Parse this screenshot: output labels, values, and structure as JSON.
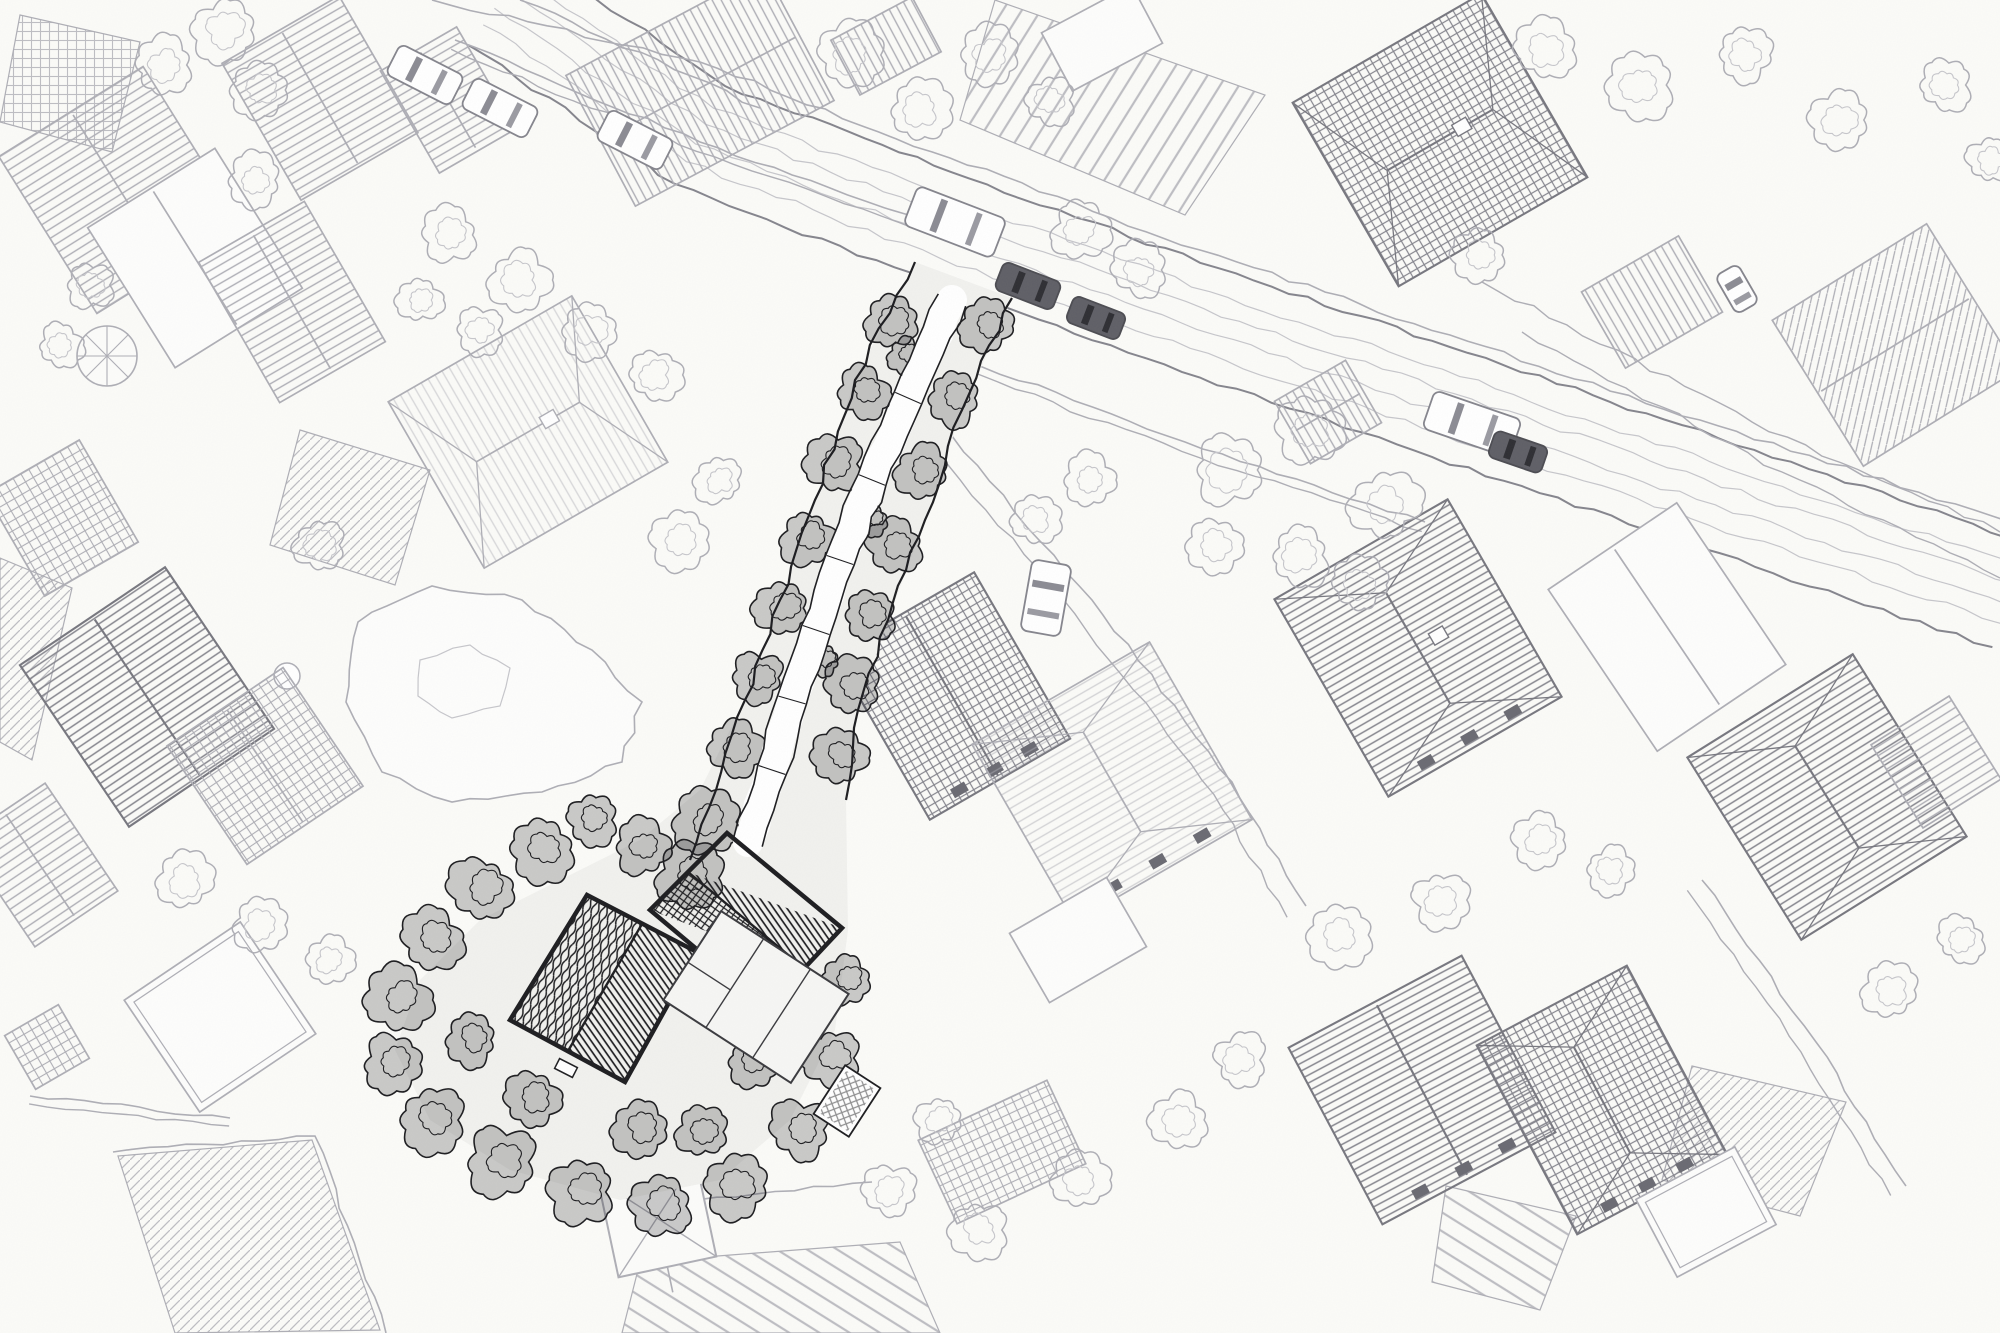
{
  "meta": {
    "title": "Hand-drawn aerial pen sketch of a residential neighborhood with one dark highlighted plot",
    "style": "pen-and-ink aerial view, no text, no UI chrome"
  },
  "canvas": {
    "w": 2000,
    "h": 1333
  },
  "palette": {
    "paper": "#fbfbf8",
    "paper_shade": "#f1f1ee",
    "ink_faint": "#c6c6cb",
    "ink_light": "#aeaeb5",
    "ink_mid": "#85858d",
    "ink_dark": "#1d1d20",
    "veg_dark_fill": "rgba(25,25,28,0.22)",
    "car_dark": "#5f5f66",
    "window_dark": "#6a6a72"
  },
  "road": {
    "center": [
      [
        500,
        0
      ],
      [
        700,
        135
      ],
      [
        950,
        230
      ],
      [
        1200,
        320
      ],
      [
        1450,
        405
      ],
      [
        1700,
        490
      ],
      [
        2010,
        595
      ]
    ],
    "half_width": 55,
    "inner_offsets": [
      -30,
      -12,
      10,
      30
    ],
    "sidewalk_north": [
      [
        432,
        0
      ],
      [
        700,
        62
      ],
      [
        950,
        158
      ],
      [
        1200,
        250
      ],
      [
        1450,
        335
      ],
      [
        1700,
        420
      ],
      [
        2010,
        522
      ]
    ],
    "verge_curves": [
      [
        [
          1482,
          282
        ],
        [
          1752,
          422
        ],
        [
          2000,
          532
        ]
      ],
      [
        [
          1522,
          332
        ],
        [
          1782,
          472
        ],
        [
          2000,
          578
        ]
      ]
    ]
  },
  "houses": [
    {
      "cx": 120,
      "cy": 190,
      "w": 170,
      "h": 185,
      "rot": -32,
      "fill": "stripe",
      "tone": "light",
      "roof": "gable"
    },
    {
      "cx": 195,
      "cy": 258,
      "w": 150,
      "h": 165,
      "rot": -32,
      "fill": "plain",
      "tone": "light",
      "roof": "gable"
    },
    {
      "cx": 320,
      "cy": 98,
      "w": 135,
      "h": 158,
      "rot": -30,
      "fill": "stripe",
      "tone": "light",
      "roof": "gable"
    },
    {
      "cx": 448,
      "cy": 100,
      "w": 88,
      "h": 118,
      "rot": -30,
      "fill": "stripe",
      "tone": "light",
      "roof": "gable"
    },
    {
      "cx": 700,
      "cy": 88,
      "w": 225,
      "h": 148,
      "rot": -28,
      "fill": "stripe",
      "tone": "light",
      "roof": "gable"
    },
    {
      "cx": 292,
      "cy": 302,
      "w": 122,
      "h": 162,
      "rot": -30,
      "fill": "stripe",
      "tone": "light",
      "roof": "gable"
    },
    {
      "cx": 528,
      "cy": 432,
      "w": 212,
      "h": 192,
      "rot": -30,
      "fill": "stripe",
      "fo": 0.45,
      "tone": "light",
      "roof": "hip",
      "chimney": true
    },
    {
      "cx": 952,
      "cy": 696,
      "w": 162,
      "h": 192,
      "rot": -30,
      "fill": "grid",
      "tone": "mid",
      "roof": "gable",
      "windows": true
    },
    {
      "cx": 1112,
      "cy": 782,
      "w": 205,
      "h": 205,
      "rot": -30,
      "fill": "stripe",
      "fo": 0.5,
      "tone": "light",
      "roof": "hip",
      "windows": true
    },
    {
      "cx": 1440,
      "cy": 140,
      "w": 218,
      "h": 212,
      "rot": -30,
      "fill": "grid",
      "tone": "mid",
      "roof": "hip",
      "chimney": true
    },
    {
      "cx": 1652,
      "cy": 302,
      "w": 112,
      "h": 88,
      "rot": -30,
      "fill": "stripe",
      "tone": "light",
      "roof": "flat"
    },
    {
      "cx": 1895,
      "cy": 345,
      "w": 182,
      "h": 172,
      "rot": -32,
      "fill": "hatch",
      "tone": "light",
      "roof": "gable"
    },
    {
      "cx": 1418,
      "cy": 648,
      "w": 200,
      "h": 228,
      "rot": -30,
      "fill": "stripe",
      "tone": "mid",
      "roof": "hip",
      "windows": true,
      "chimney": true
    },
    {
      "cx": 1667,
      "cy": 627,
      "w": 155,
      "h": 195,
      "rot": -34,
      "fill": "plain",
      "tone": "light",
      "roof": "gable"
    },
    {
      "cx": 1827,
      "cy": 797,
      "w": 195,
      "h": 215,
      "rot": -32,
      "fill": "stripe",
      "tone": "mid",
      "roof": "hip"
    },
    {
      "cx": 1422,
      "cy": 1090,
      "w": 196,
      "h": 200,
      "rot": -28,
      "fill": "stripe",
      "tone": "mid",
      "roof": "gable",
      "windows": true
    },
    {
      "cx": 1602,
      "cy": 1100,
      "w": 170,
      "h": 214,
      "rot": -28,
      "fill": "grid",
      "tone": "mid",
      "roof": "hip",
      "windows": true
    },
    {
      "cx": 147,
      "cy": 697,
      "w": 175,
      "h": 195,
      "rot": -34,
      "fill": "stripe",
      "tone": "mid",
      "roof": "gable"
    },
    {
      "cx": 265,
      "cy": 766,
      "w": 140,
      "h": 143,
      "rot": -34,
      "fill": "grid",
      "tone": "light",
      "roof": "gable"
    },
    {
      "cx": 62,
      "cy": 518,
      "w": 108,
      "h": 118,
      "rot": -30,
      "fill": "grid",
      "tone": "light",
      "roof": "flat"
    },
    {
      "cx": 220,
      "cy": 1017,
      "w": 140,
      "h": 135,
      "rot": -34,
      "fill": "plain",
      "tone": "light",
      "roof": "flat",
      "inner": true
    },
    {
      "cx": 47,
      "cy": 1047,
      "w": 62,
      "h": 62,
      "rot": -30,
      "fill": "grid",
      "tone": "light",
      "roof": "flat"
    },
    {
      "cx": 1328,
      "cy": 412,
      "w": 82,
      "h": 72,
      "rot": -30,
      "fill": "stripe",
      "tone": "light",
      "roof": "gable"
    },
    {
      "cx": 886,
      "cy": 46,
      "w": 92,
      "h": 62,
      "rot": -28,
      "fill": "stripe",
      "tone": "light",
      "roof": "flat"
    },
    {
      "cx": 1102,
      "cy": 38,
      "w": 102,
      "h": 66,
      "rot": -28,
      "fill": "plain",
      "tone": "light",
      "roof": "flat"
    },
    {
      "cx": 40,
      "cy": 865,
      "w": 100,
      "h": 130,
      "rot": -34,
      "fill": "stripe",
      "tone": "light",
      "roof": "gable"
    },
    {
      "cx": 1936,
      "cy": 762,
      "w": 92,
      "h": 98,
      "rot": -32,
      "fill": "stripe",
      "tone": "light",
      "roof": "flat"
    },
    {
      "cx": 1002,
      "cy": 1152,
      "w": 142,
      "h": 92,
      "rot": -25,
      "fill": "grid",
      "tone": "light",
      "roof": "flat"
    },
    {
      "cx": 1706,
      "cy": 1212,
      "w": 112,
      "h": 88,
      "rot": -28,
      "fill": "plain",
      "tone": "light",
      "roof": "flat",
      "inner": true
    },
    {
      "cx": 1078,
      "cy": 940,
      "w": 112,
      "h": 80,
      "rot": -30,
      "fill": "plain",
      "tone": "light",
      "roof": "flat"
    }
  ],
  "pavilion": {
    "cx": 657,
    "cy": 1218,
    "size": 100,
    "rot": -12
  },
  "gazebo": {
    "cx": 107,
    "cy": 356,
    "r": 30
  },
  "ball": {
    "cx": 287,
    "cy": 676,
    "r": 13
  },
  "plot": {
    "strip_fill": [
      [
        915,
        262
      ],
      [
        1012,
        298
      ],
      [
        962,
        410
      ],
      [
        925,
        520
      ],
      [
        888,
        620
      ],
      [
        858,
        710
      ],
      [
        846,
        800
      ],
      [
        848,
        930
      ],
      [
        835,
        1030
      ],
      [
        790,
        1120
      ],
      [
        720,
        1180
      ],
      [
        620,
        1200
      ],
      [
        510,
        1170
      ],
      [
        430,
        1120
      ],
      [
        395,
        1050
      ],
      [
        420,
        980
      ],
      [
        480,
        920
      ],
      [
        560,
        880
      ],
      [
        640,
        840
      ],
      [
        700,
        790
      ],
      [
        745,
        700
      ],
      [
        780,
        600
      ],
      [
        815,
        500
      ],
      [
        855,
        380
      ]
    ],
    "edge_left": [
      [
        915,
        262
      ],
      [
        855,
        380
      ],
      [
        815,
        500
      ],
      [
        780,
        600
      ],
      [
        745,
        700
      ],
      [
        716,
        790
      ],
      [
        690,
        860
      ]
    ],
    "edge_right": [
      [
        1012,
        298
      ],
      [
        962,
        410
      ],
      [
        925,
        520
      ],
      [
        888,
        620
      ],
      [
        858,
        710
      ],
      [
        846,
        800
      ]
    ],
    "driveway": [
      [
        952,
        300
      ],
      [
        908,
        398
      ],
      [
        872,
        480
      ],
      [
        840,
        560
      ],
      [
        816,
        630
      ],
      [
        792,
        700
      ],
      [
        772,
        770
      ],
      [
        748,
        842
      ]
    ],
    "buildings": [
      {
        "corners": [
          [
            587,
            895
          ],
          [
            697,
            952
          ],
          [
            625,
            1082
          ],
          [
            510,
            1020
          ]
        ],
        "ridge": [
          [
            642,
            924
          ],
          [
            568,
            1051
          ]
        ],
        "fills": [
          "scrib",
          "stripe"
        ]
      },
      {
        "corners": [
          [
            727,
            833
          ],
          [
            842,
            928
          ],
          [
            767,
            1008
          ],
          [
            650,
            910
          ]
        ],
        "ridge": [
          [
            688,
            872
          ],
          [
            804,
            968
          ]
        ],
        "fills": [
          "grid",
          "stripe"
        ]
      }
    ],
    "shell": {
      "cx": 756,
      "cy": 997,
      "w": 152,
      "h": 106,
      "rot": 33
    },
    "panel": {
      "cx": 847,
      "cy": 1101,
      "w": 42,
      "h": 58,
      "rot": 33
    },
    "porch": {
      "cx": 566,
      "cy": 1068,
      "w": 20,
      "h": 11,
      "rot": 27
    }
  },
  "trees_dark": [
    [
      892,
      322,
      26
    ],
    [
      863,
      392,
      24
    ],
    [
      834,
      464,
      27
    ],
    [
      808,
      538,
      25
    ],
    [
      782,
      608,
      26
    ],
    [
      758,
      678,
      24
    ],
    [
      734,
      748,
      26
    ],
    [
      706,
      822,
      28
    ],
    [
      986,
      326,
      24
    ],
    [
      954,
      398,
      26
    ],
    [
      922,
      472,
      25
    ],
    [
      895,
      546,
      26
    ],
    [
      870,
      616,
      24
    ],
    [
      852,
      688,
      26
    ],
    [
      840,
      758,
      25
    ],
    [
      690,
      878,
      30
    ],
    [
      642,
      848,
      26
    ],
    [
      592,
      820,
      25
    ],
    [
      542,
      850,
      28
    ],
    [
      482,
      890,
      30
    ],
    [
      432,
      940,
      28
    ],
    [
      398,
      1000,
      30
    ],
    [
      392,
      1064,
      28
    ],
    [
      432,
      1120,
      30
    ],
    [
      502,
      1162,
      32
    ],
    [
      582,
      1192,
      30
    ],
    [
      662,
      1206,
      28
    ],
    [
      736,
      1186,
      30
    ],
    [
      800,
      1130,
      28
    ],
    [
      832,
      1058,
      26
    ],
    [
      846,
      980,
      24
    ],
    [
      640,
      1130,
      26
    ],
    [
      702,
      1132,
      24
    ],
    [
      752,
      1062,
      22
    ],
    [
      532,
      1100,
      26
    ],
    [
      472,
      1040,
      24
    ],
    [
      905,
      355,
      16
    ],
    [
      872,
      520,
      15
    ],
    [
      824,
      660,
      15
    ]
  ],
  "trees_light": [
    [
      225,
      30,
      30
    ],
    [
      165,
      65,
      26
    ],
    [
      260,
      90,
      24
    ],
    [
      90,
      285,
      22
    ],
    [
      60,
      345,
      20
    ],
    [
      255,
      180,
      24
    ],
    [
      450,
      235,
      26
    ],
    [
      520,
      280,
      28
    ],
    [
      590,
      330,
      26
    ],
    [
      655,
      375,
      24
    ],
    [
      480,
      330,
      22
    ],
    [
      420,
      300,
      20
    ],
    [
      850,
      55,
      30
    ],
    [
      920,
      110,
      28
    ],
    [
      990,
      55,
      26
    ],
    [
      1050,
      100,
      22
    ],
    [
      1080,
      230,
      26
    ],
    [
      1140,
      270,
      24
    ],
    [
      1230,
      470,
      34
    ],
    [
      1310,
      430,
      30
    ],
    [
      1385,
      505,
      32
    ],
    [
      1300,
      555,
      28
    ],
    [
      1215,
      545,
      26
    ],
    [
      1360,
      585,
      24
    ],
    [
      1090,
      480,
      24
    ],
    [
      1035,
      520,
      22
    ],
    [
      1545,
      50,
      28
    ],
    [
      1640,
      85,
      30
    ],
    [
      1745,
      55,
      26
    ],
    [
      1840,
      120,
      28
    ],
    [
      1945,
      85,
      24
    ],
    [
      1990,
      160,
      22
    ],
    [
      1480,
      255,
      24
    ],
    [
      1340,
      935,
      28
    ],
    [
      1440,
      900,
      26
    ],
    [
      1240,
      1060,
      24
    ],
    [
      1180,
      1120,
      26
    ],
    [
      1080,
      1180,
      28
    ],
    [
      980,
      1230,
      26
    ],
    [
      890,
      1190,
      24
    ],
    [
      940,
      1120,
      22
    ],
    [
      185,
      880,
      26
    ],
    [
      260,
      925,
      24
    ],
    [
      330,
      960,
      22
    ],
    [
      320,
      545,
      24
    ],
    [
      680,
      540,
      26
    ],
    [
      720,
      480,
      22
    ],
    [
      1890,
      990,
      26
    ],
    [
      1960,
      940,
      22
    ],
    [
      1540,
      840,
      24
    ],
    [
      1610,
      870,
      22
    ]
  ],
  "cars": [
    {
      "x": 425,
      "y": 75,
      "rot": 27,
      "len": 72,
      "wid": 34,
      "tone": "white"
    },
    {
      "x": 500,
      "y": 108,
      "rot": 27,
      "len": 72,
      "wid": 34,
      "tone": "white"
    },
    {
      "x": 635,
      "y": 140,
      "rot": 27,
      "len": 72,
      "wid": 34,
      "tone": "white"
    },
    {
      "x": 955,
      "y": 222,
      "rot": 21,
      "len": 95,
      "wid": 42,
      "tone": "white"
    },
    {
      "x": 1028,
      "y": 286,
      "rot": 21,
      "len": 62,
      "wid": 30,
      "tone": "dark"
    },
    {
      "x": 1096,
      "y": 318,
      "rot": 21,
      "len": 56,
      "wid": 28,
      "tone": "dark"
    },
    {
      "x": 1472,
      "y": 424,
      "rot": 19,
      "len": 92,
      "wid": 40,
      "tone": "white"
    },
    {
      "x": 1518,
      "y": 452,
      "rot": 19,
      "len": 56,
      "wid": 28,
      "tone": "dark"
    },
    {
      "x": 1046,
      "y": 598,
      "rot": 100,
      "len": 72,
      "wid": 40,
      "tone": "white"
    },
    {
      "x": 1737,
      "y": 289,
      "rot": 60,
      "len": 44,
      "wid": 26,
      "tone": "white"
    }
  ],
  "fences": [
    {
      "pts": [
        [
          455,
          40
        ],
        [
          700,
          142
        ],
        [
          940,
          226
        ]
      ],
      "gap": 10
    },
    {
      "pts": [
        [
          945,
          352
        ],
        [
          1185,
          442
        ],
        [
          1425,
          522
        ]
      ],
      "gap": 10
    },
    {
      "pts": [
        [
          30,
          1096
        ],
        [
          230,
          1118
        ]
      ],
      "gap": 8
    },
    {
      "pts": [
        [
          113,
          1152
        ],
        [
          315,
          1136
        ],
        [
          386,
          1333
        ]
      ],
      "gap": 0
    },
    {
      "pts": [
        [
          952,
          436
        ],
        [
          1092,
          600
        ],
        [
          1232,
          782
        ],
        [
          1306,
          906
        ]
      ],
      "gap": 22
    },
    {
      "pts": [
        [
          1702,
          880
        ],
        [
          1816,
          1042
        ],
        [
          1906,
          1186
        ]
      ],
      "gap": 18
    },
    {
      "pts": [
        [
          520,
          0
        ],
        [
          760,
          108
        ]
      ],
      "gap": 0
    },
    {
      "pts": [
        [
          620,
          1208
        ],
        [
          872,
          1182
        ]
      ],
      "gap": 0
    }
  ],
  "patches": [
    {
      "pts": [
        [
          995,
          0
        ],
        [
          1265,
          95
        ],
        [
          1185,
          215
        ],
        [
          960,
          120
        ]
      ],
      "pat": "rows-a"
    },
    {
      "pts": [
        [
          0,
          558
        ],
        [
          72,
          588
        ],
        [
          32,
          760
        ],
        [
          0,
          742
        ]
      ],
      "pat": "hatch"
    },
    {
      "pts": [
        [
          640,
          1262
        ],
        [
          900,
          1242
        ],
        [
          940,
          1333
        ],
        [
          622,
          1333
        ]
      ],
      "pat": "rows-b"
    },
    {
      "pts": [
        [
          1446,
          1186
        ],
        [
          1576,
          1216
        ],
        [
          1540,
          1310
        ],
        [
          1432,
          1282
        ]
      ],
      "pat": "rows-b"
    },
    {
      "pts": [
        [
          1692,
          1066
        ],
        [
          1846,
          1102
        ],
        [
          1800,
          1216
        ],
        [
          1662,
          1180
        ]
      ],
      "pat": "hatch"
    },
    {
      "pts": [
        [
          20,
          15
        ],
        [
          140,
          42
        ],
        [
          112,
          152
        ],
        [
          0,
          122
        ]
      ],
      "pat": "grid"
    },
    {
      "pts": [
        [
          118,
          1156
        ],
        [
          312,
          1140
        ],
        [
          380,
          1330
        ],
        [
          175,
          1333
        ]
      ],
      "pat": "hatch"
    },
    {
      "pts": [
        [
          300,
          430
        ],
        [
          430,
          470
        ],
        [
          395,
          585
        ],
        [
          270,
          545
        ]
      ],
      "pat": "hatch"
    }
  ],
  "lawn": {
    "outer": [
      [
        358,
        622
      ],
      [
        432,
        586
      ],
      [
        522,
        600
      ],
      [
        592,
        650
      ],
      [
        642,
        702
      ],
      [
        622,
        762
      ],
      [
        542,
        792
      ],
      [
        452,
        802
      ],
      [
        382,
        772
      ],
      [
        346,
        702
      ]
    ],
    "inner": [
      [
        420,
        660
      ],
      [
        470,
        645
      ],
      [
        510,
        668
      ],
      [
        500,
        706
      ],
      [
        452,
        718
      ],
      [
        418,
        696
      ]
    ]
  }
}
